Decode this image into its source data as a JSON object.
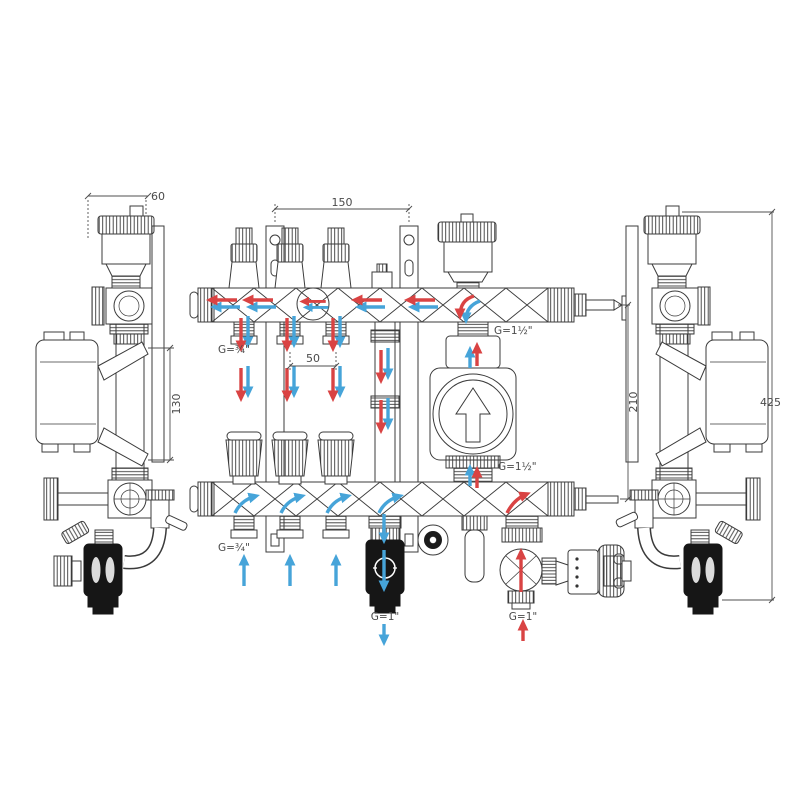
{
  "drawing": {
    "title": "Heating manifold with mixing group - technical drawing",
    "dimensions": {
      "bracket_depth": "60",
      "bracket_spacing": "150",
      "outlet_pitch": "50",
      "side_height": "130",
      "axis_distance": "210",
      "total_height": "425"
    },
    "connections": {
      "supply_outlets": "G=¾\"",
      "return_outlets": "G=¾\"",
      "pump_top": "G=1½\"",
      "pump_bottom": "G=1½\"",
      "bottom_return": "G=1\"",
      "bottom_supply": "G=1\""
    },
    "colors": {
      "line": "#3b3b3b",
      "dimension": "#4f4f4f",
      "flow_supply_red": "#d94343",
      "flow_return_blue": "#46a4d9",
      "valve_body_dark": "#161616",
      "background": "#ffffff"
    }
  }
}
